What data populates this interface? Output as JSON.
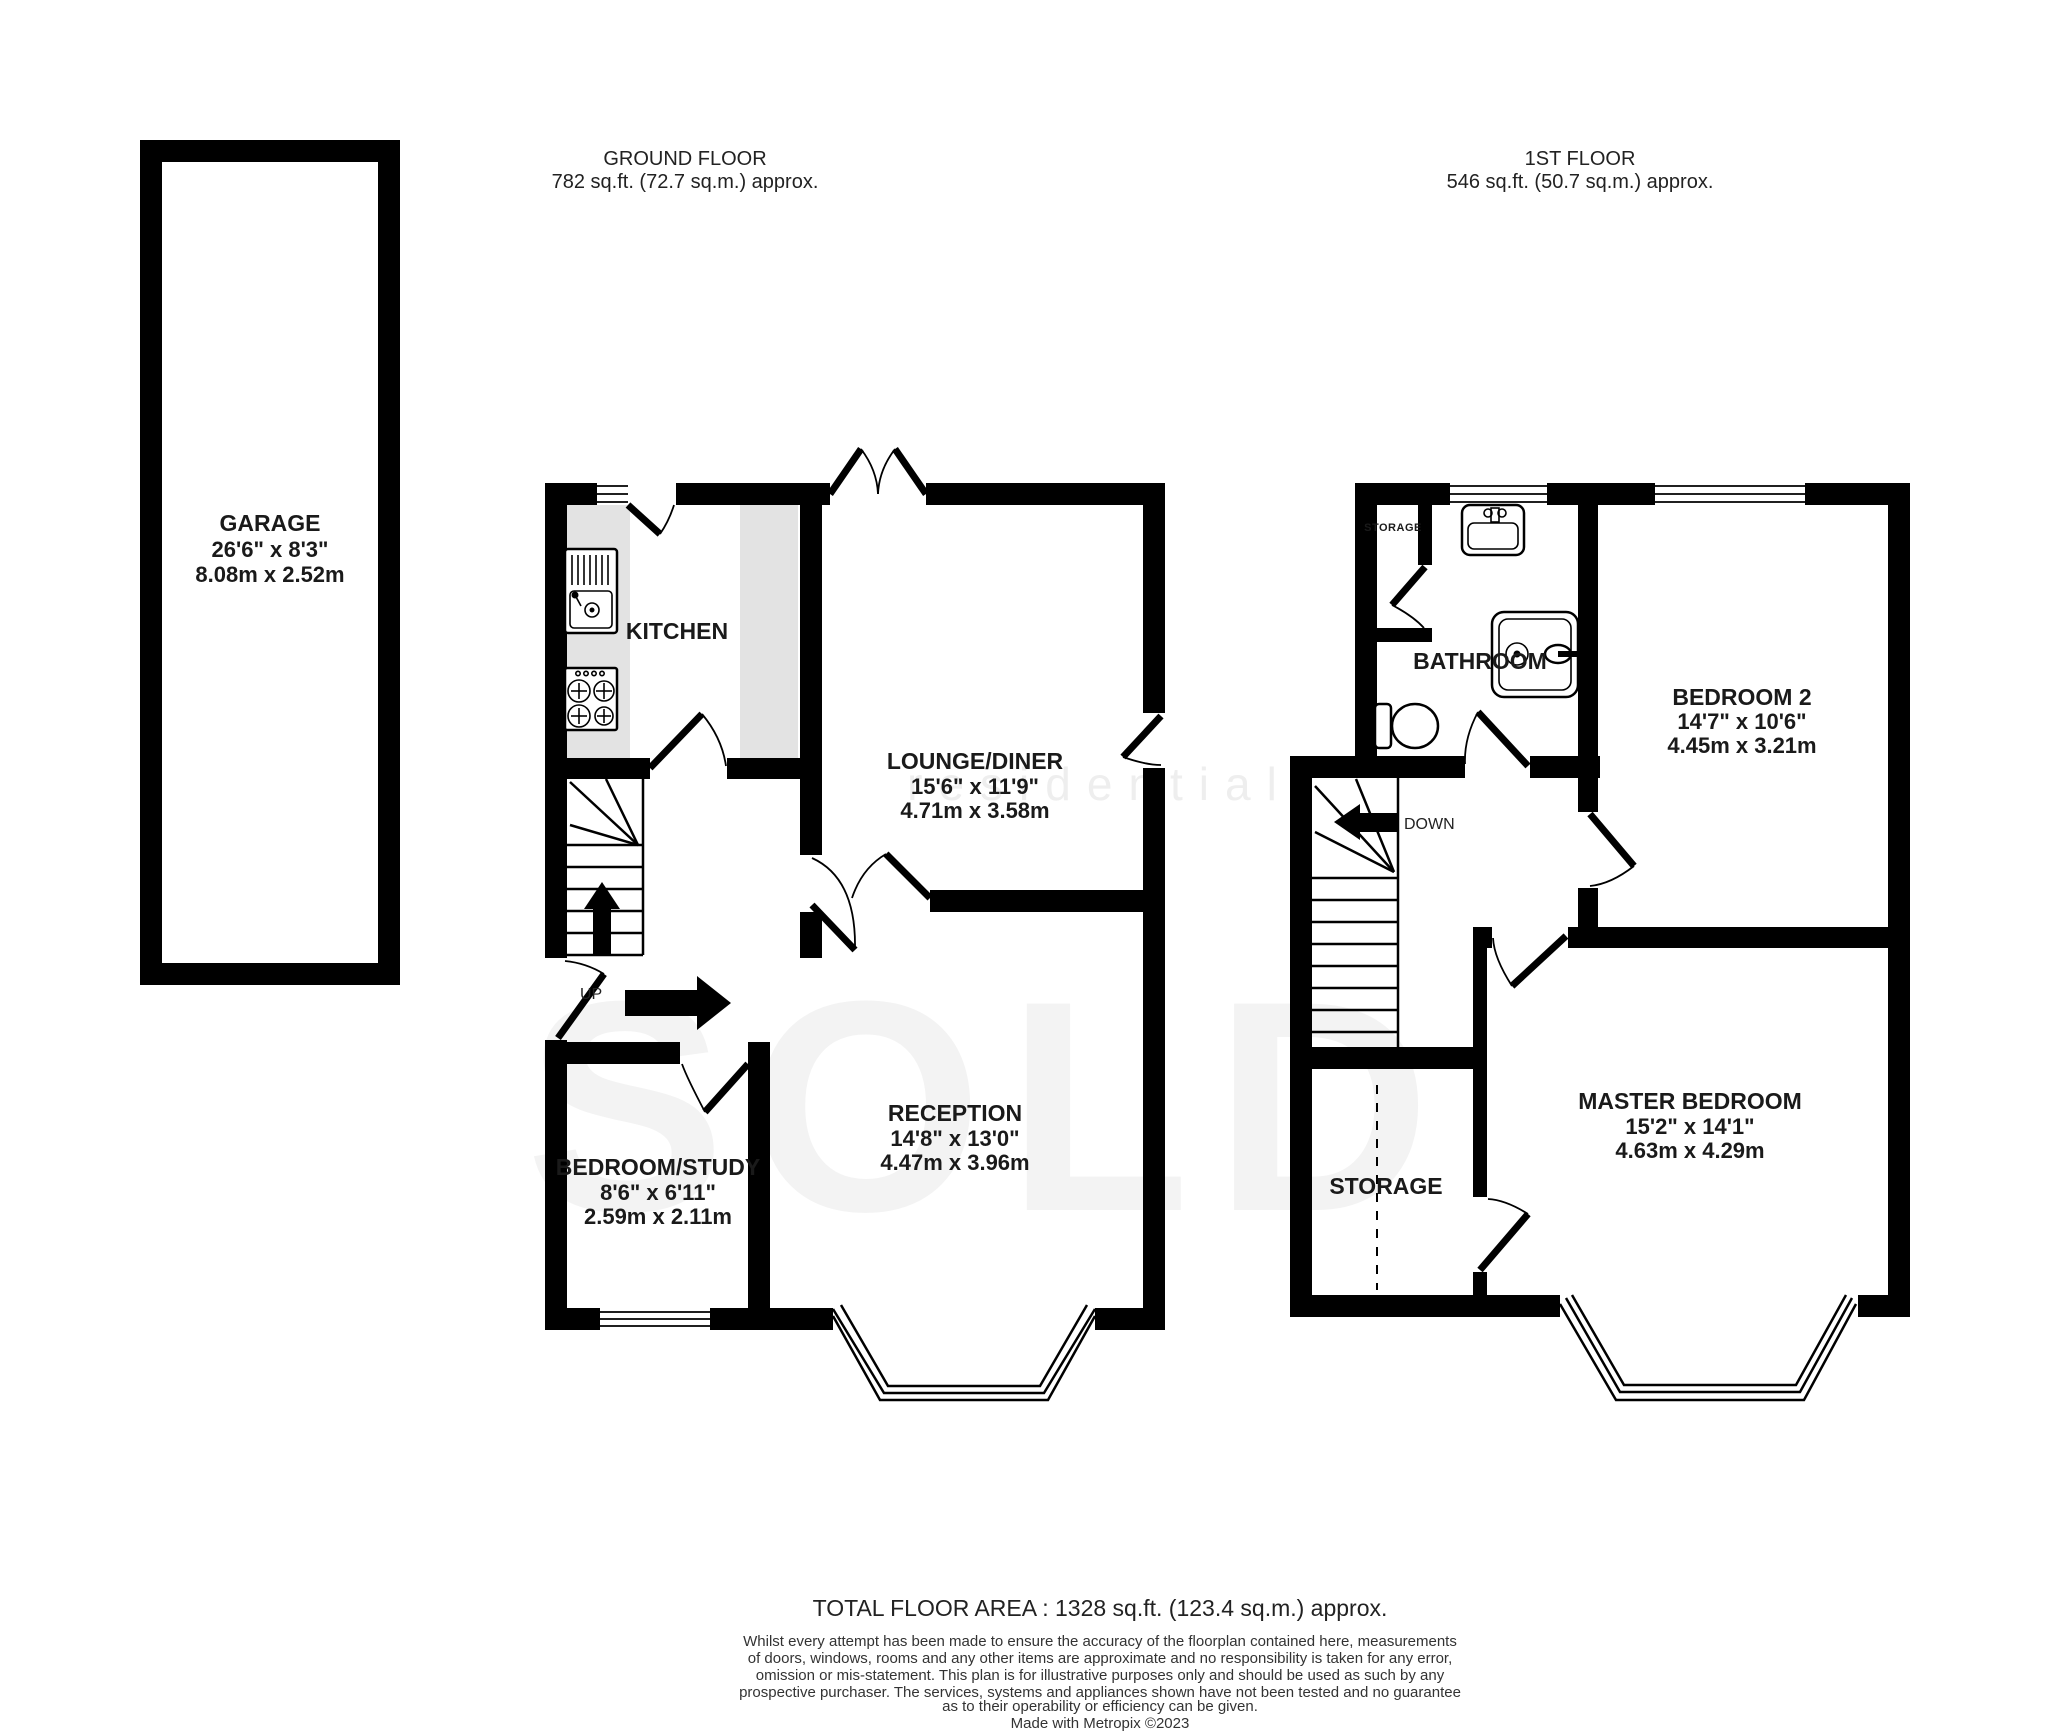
{
  "headers": {
    "ground_title": "GROUND FLOOR",
    "ground_area": "782 sq.ft. (72.7 sq.m.) approx.",
    "first_title": "1ST FLOOR",
    "first_area": "546 sq.ft. (50.7 sq.m.) approx."
  },
  "rooms": {
    "garage": {
      "name": "GARAGE",
      "imperial": "26'6\"  x 8'3\"",
      "metric": "8.08m  x 2.52m"
    },
    "kitchen": {
      "name": "KITCHEN"
    },
    "lounge": {
      "name": "LOUNGE/DINER",
      "imperial": "15'6\"  x 11'9\"",
      "metric": "4.71m  x 3.58m"
    },
    "reception": {
      "name": "RECEPTION",
      "imperial": "14'8\"  x 13'0\"",
      "metric": "4.47m  x 3.96m"
    },
    "bedroom_study": {
      "name": "BEDROOM/STUDY",
      "imperial": "8'6\"  x 6'11\"",
      "metric": "2.59m  x 2.11m"
    },
    "bathroom": {
      "name": "BATHROOM"
    },
    "bedroom2": {
      "name": "BEDROOM 2",
      "imperial": "14'7\"  x 10'6\"",
      "metric": "4.45m  x 3.21m"
    },
    "master": {
      "name": "MASTER BEDROOM",
      "imperial": "15'2\"  x 14'1\"",
      "metric": "4.63m  x 4.29m"
    },
    "storage_room": {
      "name": "STORAGE"
    },
    "storage_closet": {
      "name": "STORAGE"
    }
  },
  "stairs": {
    "up": "UP",
    "down": "DOWN"
  },
  "watermark": {
    "line1": "residential",
    "line2": "SOLD"
  },
  "colors": {
    "wall": "#000000",
    "counter": "#e3e3e3",
    "watermark": "#f3f3f3"
  },
  "footer": {
    "total": "TOTAL FLOOR AREA : 1328 sq.ft. (123.4 sq.m.) approx.",
    "disclaimer": [
      "Whilst every attempt has been made to ensure the accuracy of the floorplan contained here, measurements",
      "of doors, windows, rooms and any other items are approximate and no responsibility is taken for any error,",
      "omission or mis-statement. This plan is for illustrative purposes only and should be used as such by any",
      "prospective purchaser. The services, systems and appliances shown have not been tested and no guarantee",
      "as to their operability or efficiency can be given."
    ],
    "credit": "Made with Metropix ©2023"
  }
}
